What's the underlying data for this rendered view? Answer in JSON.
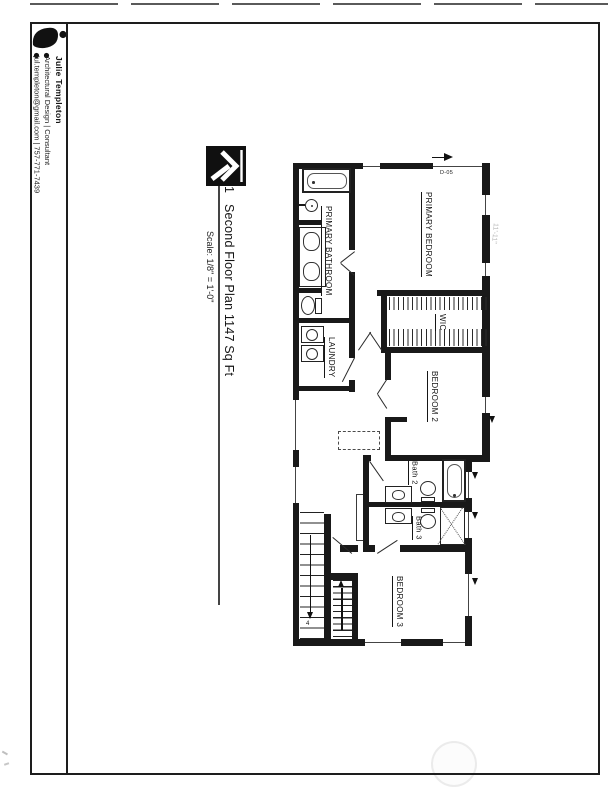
{
  "document": {
    "artist_block": {
      "logo_icon": "jt-monogram-logo",
      "name": "Julie Templeton",
      "tagline": "Architectural Design | Consultant",
      "contact": "jul.templeton@gmail.com | 757-771-7439"
    },
    "title_block": {
      "north_icon": "north-arrow",
      "drawing_number": "1",
      "title": "Second Floor Plan 1147 Sq Ft",
      "scale": "Scale: 1/8\" = 1'-0\""
    },
    "plan": {
      "rooms": [
        {
          "label": "PRIMARY BEDROOM"
        },
        {
          "label": "PRIMARY BATHROOM"
        },
        {
          "label": "WIC"
        },
        {
          "label": "LAUNDRY"
        },
        {
          "label": "BEDROOM 2"
        },
        {
          "label": "Bath 2"
        },
        {
          "label": "Bath 3"
        },
        {
          "label": "BEDROOM 3"
        }
      ],
      "annotations": {
        "door_tag": "D-05",
        "dimension": "11'-11\"",
        "stair_label": "4"
      }
    }
  }
}
